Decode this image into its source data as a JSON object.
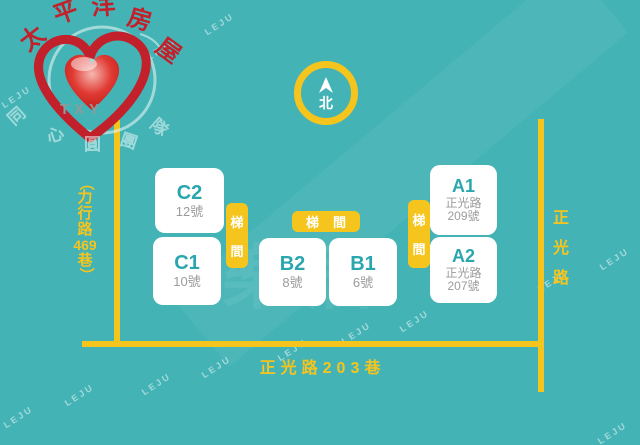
{
  "colors": {
    "background": "#44b3b5",
    "accent_yellow": "#f5c51d",
    "block_background": "#ffffff",
    "block_title_teal": "#2aa6ae",
    "block_subtitle_gray": "#9b9b9b",
    "logo_red": "#c2202a",
    "white": "#ffffff"
  },
  "logo": {
    "brand_chars": [
      "太",
      "平",
      "洋",
      "房",
      "屋"
    ],
    "team_chars": [
      "同",
      "心",
      "圓",
      "團",
      "隊"
    ],
    "txy": "TXY"
  },
  "compass": {
    "north_label": "北"
  },
  "buildings": {
    "c2": {
      "label": "C2",
      "line1": "12號"
    },
    "c1": {
      "label": "C1",
      "line1": "10號"
    },
    "b2": {
      "label": "B2",
      "line1": "8號"
    },
    "b1": {
      "label": "B1",
      "line1": "6號"
    },
    "a1": {
      "label": "A1",
      "line1": "正光路",
      "line2": "209號"
    },
    "a2": {
      "label": "A2",
      "line1": "正光路",
      "line2": "207號"
    }
  },
  "stairs": {
    "char1": "梯",
    "char2": "間",
    "horizontal_label": "梯間"
  },
  "streets": {
    "left_chars": [
      "（",
      "力",
      "行",
      "路",
      "469",
      "巷",
      "）"
    ],
    "right_chars": [
      "正",
      "光",
      "路"
    ],
    "bottom_label": "正光路203巷"
  },
  "watermark": {
    "text": "LEJU",
    "center_text": "樂居"
  }
}
